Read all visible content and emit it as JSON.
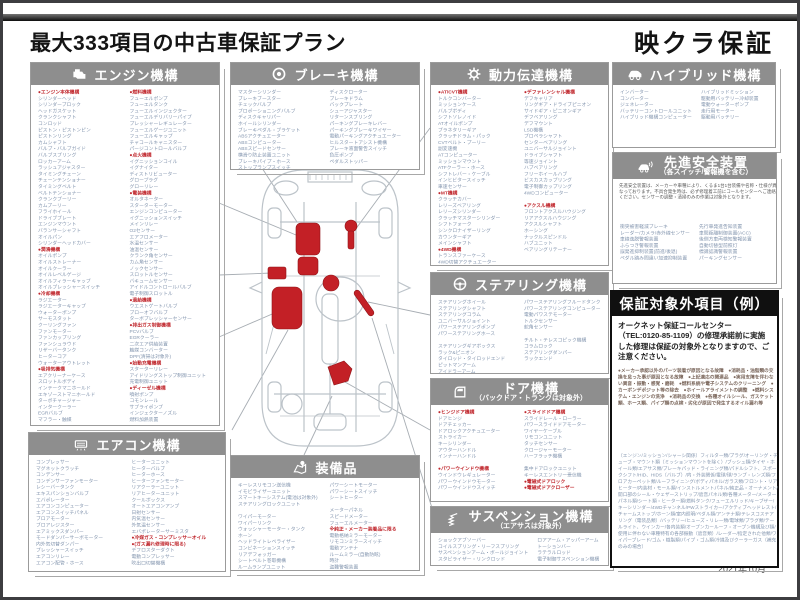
{
  "page": {
    "title": "最大333項目の中古車保証プラン",
    "brand": "映クラ保証",
    "date": "2021年10月"
  },
  "colors": {
    "header_bg": "#8e8e8e",
    "accent_red": "#c0272d",
    "list_text": "#8496af",
    "exclusion_header_bg": "#101010"
  },
  "sections": {
    "engine": {
      "title": "エンジン機構",
      "col1": [
        "●エンジン本体機構",
        "シリンダーヘッド",
        "シリンダーブロック",
        "ヘッドガスケット",
        "クランクシャフト",
        "コンロッド",
        "ピストン・ピストンピン",
        "ピストンリング",
        "カムシャフト",
        "バルブ・バルブガイド",
        "バルブスプリング",
        "ロッカーアーム",
        "ラッシュアジャスター",
        "タイミングチェーン",
        "チェーンテンショナー",
        "タイミングベルト",
        "ベルトテンショナー",
        "クランクプーリー",
        "カムプーリー",
        "フライホイール",
        "ドライブプレート",
        "エンジンマウント",
        "バランサーシャフト",
        "オイルパン",
        "シリンダーヘッドカバー",
        "●潤滑機構",
        "オイルポンプ",
        "オイルストレーナー",
        "オイルクーラー",
        "オイルレベルゲージ",
        "オイルフィラーキャップ",
        "オイルプレッシャースイッチ",
        "●冷却機構",
        "ラジエーター",
        "ラジエーターキャップ",
        "ウォーターポンプ",
        "サーモスタット",
        "クーリングファン",
        "ファンモーター",
        "ファンカップリング",
        "ファンシュラウド",
        "リザーバータンク",
        "ヒーターコア",
        "ウォーターアウトレット",
        "●吸排気機構",
        "エアクリーナーケース",
        "スロットルボディ",
        "インテークマニホールド",
        "エキゾーストマニホールド",
        "ターボチャージャー",
        "インタークーラー",
        "EGRバルブ",
        "マフラー・触媒"
      ],
      "col2": [
        "●燃料機構",
        "フューエルポンプ",
        "フューエルタンク",
        "フューエルインジェクター",
        "フューエルデリバリーパイプ",
        "プレッシャーレギュレーター",
        "フューエルゲージユニット",
        "フューエルキャップ",
        "チャコールキャニスター",
        "パージコントロールバルブ",
        "●点火機構",
        "イグニッションコイル",
        "イグナイター",
        "ディストリビューター",
        "グロープラグ",
        "グローリレー",
        "●電装機構",
        "オルタネーター",
        "スターターモーター",
        "エンジンコンピューター",
        "イグニッションスイッチ",
        "メインリレー",
        "O2センサー",
        "エアフロメーター",
        "水温センサー",
        "油温センサー",
        "クランク角センサー",
        "カム角センサー",
        "ノックセンサー",
        "スロットルセンサー",
        "バキュームセンサー",
        "アイドルコントロールバルブ",
        "電子制御スロットル",
        "●過給機構",
        "ウエストゲートバルブ",
        "ブローオフバルブ",
        "ターボプレッシャーセンサー",
        "●排出ガス制御機構",
        "PCVバルブ",
        "EGRクーラー",
        "二次エア供給装置",
        "触媒コンバーター",
        "DPF(清掃は対象外)",
        "●始動充電機構",
        "スターターリレー",
        "アイドリングストップ制御ユニット",
        "充電制御ユニット",
        "●ディーゼル機構",
        "噴射ポンプ",
        "コモンレール",
        "サプライポンプ",
        "インジェクターノズル",
        "燃料加熱装置"
      ]
    },
    "brake": {
      "title": "ブレーキ機構",
      "col1": [
        "マスターシリンダー",
        "ブレーキブースター",
        "チェックバルブ",
        "プロポーショニングバルブ",
        "ディスクキャリパー",
        "ホイールシリンダー",
        "ブレーキペダル・ブラケット",
        "ABSアクチュエーター",
        "ABSコンピューター",
        "ABSスピードセンサー",
        "横滑り防止装置ユニット",
        "ブレーキパイプ・ホース",
        "ストップランプスイッチ"
      ],
      "col2": [
        "ディスクローター",
        "ブレーキドラム",
        "バックプレート",
        "シューアジャスター",
        "リターンスプリング",
        "パーキングブレーキレバー",
        "パーキングブレーキワイヤー",
        "電動パーキングアクチュエーター",
        "ヒルスタートアシスト機構",
        "ブレーキ液面警告スイッチ",
        "負圧ポンプ",
        "ペダルストッパー"
      ]
    },
    "power": {
      "title": "動力伝達機構",
      "col1": [
        "●AT/CVT機構",
        "トルクコンバーター",
        "ミッションケース",
        "バルブボディ",
        "シフトソレノイド",
        "ATオイルポンプ",
        "プラネタリーギア",
        "クラッチドラム・パック",
        "CVTベルト・プーリー",
        "副変速機",
        "ATコンピューター",
        "ミッションマウント",
        "ATFクーラー・ホース",
        "シフトレバー・ケーブル",
        "インヒビタースイッチ",
        "車速センサー",
        "●MT機構",
        "クラッチカバー",
        "レリーズベアリング",
        "レリーズシリンダー",
        "クラッチマスターシリンダー",
        "シフトフォーク",
        "シンクロナイザーリング",
        "カウンターギア",
        "メインシャフト",
        "●4WD機構",
        "トランスファーケース",
        "4WD切替アクチュエーター"
      ],
      "col2": [
        "●デファレンシャル機構",
        "デフキャリア",
        "リングギア・ドライブピニオン",
        "サイドギア・ピニオンギア",
        "デフベアリング",
        "デフマウント",
        "LSD機構",
        "プロペラシャフト",
        "センターベアリング",
        "ユニバーサルジョイント",
        "ドライブシャフト",
        "等速ジョイント",
        "ハブベアリング",
        "フリーホイールハブ",
        "ビスカスカップリング",
        "電子制御カップリング",
        "4WDコンピューター",
        "",
        "●アクスル機構",
        "フロントアクスルハウジング",
        "リアアクスルハウジング",
        "アクスルシャフト",
        "ホーシング",
        "ナックルスピンドル",
        "ハブユニット",
        "ベアリングリテーナー"
      ]
    },
    "steering": {
      "title": "ステアリング機構",
      "col1": [
        "ステアリングホイール",
        "ステアリングシャフト",
        "ステアリングコラム",
        "ユニバーサルジョイント",
        "パワーステアリングポンプ",
        "パワーステアリングホース",
        "",
        "ステアリングギアボックス",
        "ラック&ピニオン",
        "タイロッド・タイロッドエンド",
        "ピットマンアーム",
        "アイドラーアーム"
      ],
      "col2": [
        "パワーステアリングフルードタンク",
        "パワーステアリングコンピューター",
        "電動パワステモーター",
        "トルクセンサー",
        "舵角センサー",
        "",
        "チルト・テレスコピック機構",
        "コラムロック",
        "ステアリングダンパー",
        "ラックエンド"
      ]
    },
    "door": {
      "title": "ドア機構",
      "subtitle": "（バックドア・トランクは対象外）",
      "col1": [
        "●ヒンジドア機構",
        "ドアヒンジ",
        "ドアチェッカー",
        "ドアロックアクチュエーター",
        "ストライカー",
        "キーシリンダー",
        "アウターハンドル",
        "インナーハンドル",
        "",
        "●パワーウインドウ機構",
        "ウインドウレギュレーター",
        "パワーウインドウモーター",
        "パワーウインドウスイッチ"
      ],
      "col2": [
        "●スライドドア機構",
        "スライドレール・ローラー",
        "パワースライドドアモーター",
        "ワイヤーケーブル",
        "リモコンユニット",
        "タッチセンサー",
        "クロージャーモーター",
        "ハーフラッチ機構",
        "",
        "集中ドアロックユニット",
        "キーレスエントリー受信機",
        "●電磁式ドアロック",
        "●電磁式ドアクローザー"
      ]
    },
    "suspension": {
      "title": "サスペンション機構",
      "subtitle": "（エアサスは対象外）",
      "col1": [
        "ショックアブソーバー",
        "コイルスプリング・リーフスプリング",
        "サスペンションアーム・ボールジョイント",
        "スタビライザー・リンクロッド"
      ],
      "col2": [
        "ロアアーム・アッパーアーム",
        "トーションバー",
        "ラテラルロッド",
        "電子制御サスペンション機構"
      ]
    },
    "aircon": {
      "title": "エアコン機構",
      "col1": [
        "コンプレッサー",
        "マグネットクラッチ",
        "コンデンサー",
        "コンデンサーファンモーター",
        "レシーバータンク",
        "エキスパンションバルブ",
        "エバポレーター",
        "エアコンコンピューター",
        "エアコンスイッチパネル",
        "ブロアモーター",
        "ブロアレジスター",
        "エアミックスダンパー",
        "モードダンパーサーボモーター",
        "内外気切替ダンパー",
        "プレッシャースイッチ",
        "エアコンリレー",
        "エアコン配管・ホース"
      ],
      "col2": [
        "ヒーターユニット",
        "ヒーターバルブ",
        "ヒーターホース",
        "ヒーターファンモーター",
        "リアクーラーユニット",
        "リアヒーターユニット",
        "クールボックス",
        "オートエアコンアンプ",
        "日射センサー",
        "内気温センサー",
        "外気温センサー",
        "エバポレーターサーミスタ",
        "●冷媒ガス・コンプレッサーオイル",
        "●(ガス漏れ修理時に限る)",
        "デフロスターダクト",
        "電動コンプレッサー",
        "吹出口切替機構"
      ]
    },
    "equipment": {
      "title": "装備品",
      "col1": [
        "キーレスリモコン送信機",
        "イモビライザーユニット",
        "スマートキーシステム(電池は対象外)",
        "ステアリングロックユニット",
        "",
        "ワイパーモーター",
        "ワイパーリンク",
        "ウォッシャーモーター・タンク",
        "ホーン",
        "ヘッドライトレベライザー",
        "コンビネーションスイッチ",
        "リアデフォッガー",
        "シートベルト巻取機構",
        "ルームランプユニット"
      ],
      "col2": [
        "パワーシートモーター",
        "パワーシートスイッチ",
        "シートヒーター",
        "",
        "メーターパネル",
        "スピードメーター",
        "フューエルメーター",
        "※純正・メーカー装着品に限る",
        "電動格納ミラーモーター",
        "リモコンミラースイッチ",
        "電動アンテナ",
        "ルームミラー(自動防眩)",
        "時計",
        "盗難警報装置"
      ]
    },
    "hybrid": {
      "title": "ハイブリッド機構",
      "col1": [
        "インバーター",
        "コンバーター",
        "ジェネレーター",
        "バッテリーコントロールユニット",
        "ハイブリッド機構コンピューター"
      ],
      "col2": [
        "ハイブリッドミッション",
        "駆動用バッテリー冷却装置",
        "電動ウォーターポンプ",
        "走行用モーター",
        "駆動用バッテリー"
      ],
      "note": "※ハイブリッド機構はオプション（有償）です。"
    },
    "safety": {
      "title": "先進安全装置",
      "subtitle": "（各スイッチ/警報機を含む）",
      "paragraph": "先進安全装置は、メーカーや車種により、くるま1台1台装備や名称・仕様が異なっております。不具合発生時は、必ず修理着工前にコールセンターへご連絡ください。センサーの調整・清掃のみの作業は対象外となります。",
      "col1": [
        "衝突被害軽減ブレーキ",
        "レーダー/カメラ/赤外線センサー",
        "車線逸脱警報装置",
        "ふらつき警報装置",
        "誤発進抑制装置(前進/後退)",
        "ペダル踏み間違い加速抑制装置"
      ],
      "col2": [
        "先行車発進告知装置",
        "車間距離制御装置(ACC)",
        "後側方車両検知警報装置",
        "自動切替型前照灯",
        "標識認識警報装置",
        "パーキングセンサー"
      ],
      "note": "※先進安全装置はオプション（有償）です。"
    },
    "exclusion": {
      "title": "保証対象外項目（例）",
      "intro": "オークネット保証コールセンター（TEL:0120-85-1109）の修理承諾前に実施した修理は保証の対象外となりますので、ご注意ください。",
      "bullets": "●メーカー承認以外のパーツ装着が原因となる故障　●消耗品・油脂類の交換を怠った事が原因となる故障　●上記適応の関連品　●実用支障を伴わない異音・振動・感覚・磨耗　●燃料系統や電子システムのクリーニング　●カーボンデポジット等の除去　●ホイールアライメントの調整　●燃料システム・エンジンの洗浄　●消耗品の交換　●各種オイルシール、ガスケット類、ホース類、パイプ類の点検・劣化が原因で発生するオイル漏れ等",
      "details": "（エンジン/ミッション/シャーシ関係）フィルター類/プラグ/オーリング・チューブ・マウント類（ミッションマウントを除く）/ブッシュ類/タイヤ・ホイール類/エアサス類/ブレーキパッド・ライニング類/パドルシフト、スポークシフト/HID、HIDS（バルブ）/内・外装関係/電球/球/ランプ・レンズ類/フロアカーペット類/ルーフライニング/ボディパネル/ガラス類/フロント・リアヒーター/内装材・モール類/インストルメントパネル/純正品・オーナメント/開口部のシール・ウェザーストリップ/遮音パネル類/各種メーター/メーターパネル類/シート類・ヒーター類/燃料タンク/フューエルリッド/キーブザー/キーシリンダー/4WDチャンネル/PWストライカー/アクティブヘッドレスト/チャームストップ/ホーン類/室内照明/ペダル類/アンテナ類/テレスコステアリング（電装品類）/バッテリー/ヒューズ・リレー類/電球類/プラグ類/テールライト、ウインカー/各内装類/オープンカールーフ・オープン機構及び類/使用に伴わない車種特有の各部振動（遮音類）/レーダー/指定された他類/ワイパーブレード/ゴム・樹脂類/パイプ・ゴム類/冷媒及びクーラーガス（補充のみの場合）"
    }
  }
}
